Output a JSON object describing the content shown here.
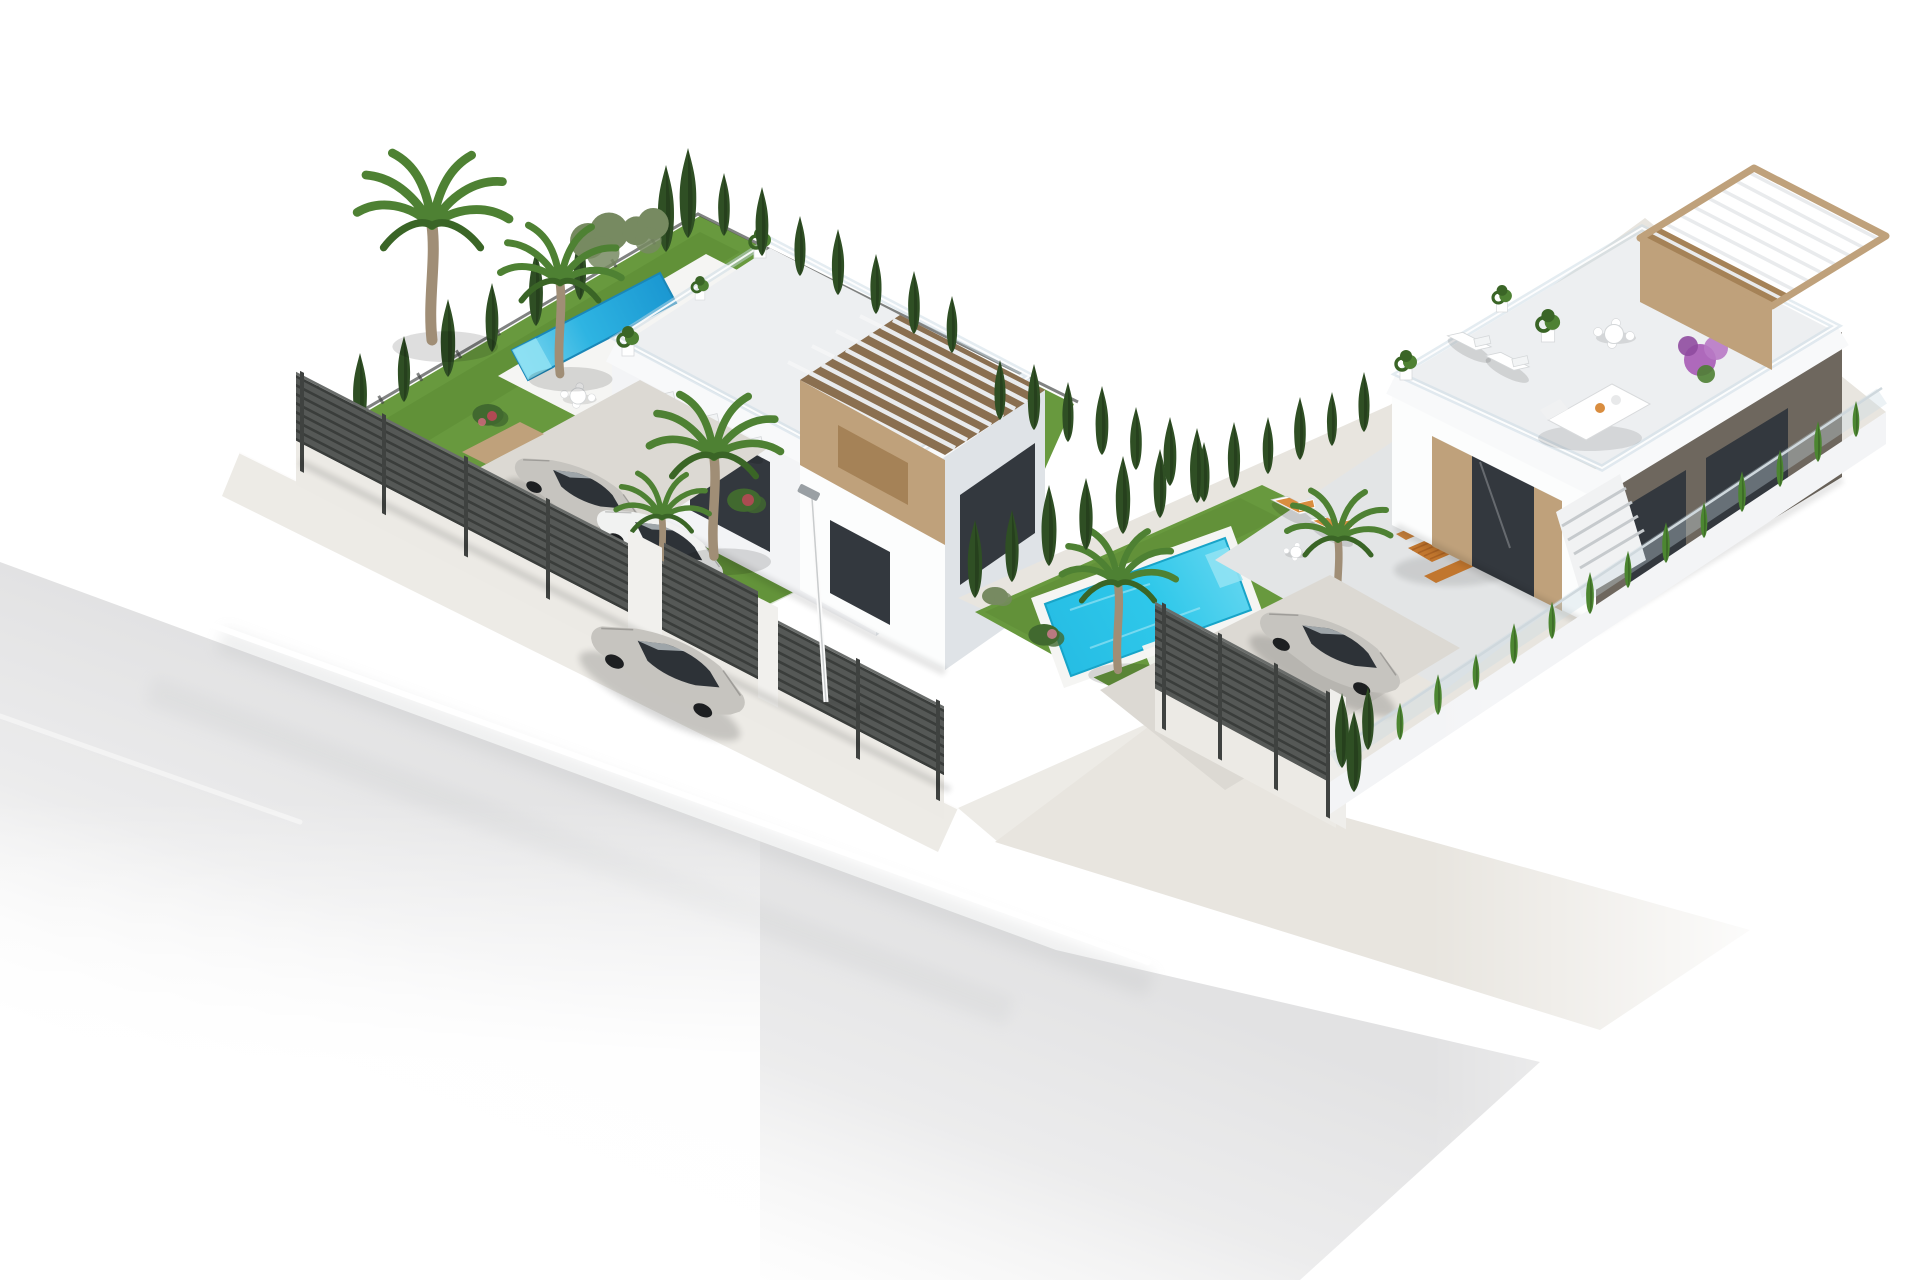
{
  "meta": {
    "canvas_width": 1920,
    "canvas_height": 1280,
    "type": "3d-architectural-render",
    "description": "Aerial isometric 3D visualization on a white background: two modern flat-roof villas on landscaped corner plots with private pools, gardens, cypress hedges, slatted fences, parked cars, a street lamp and a silver sedan driving on the street."
  },
  "colors": {
    "background": "#ffffff",
    "road": "#e3e3e4",
    "road_line": "#ffffff",
    "sidewalk": "#edebe6",
    "paver": "#e8e5df",
    "driveway": "#dcd9d3",
    "lawn": "#68993e",
    "lawn_dark": "#4f7d2c",
    "cypress": "#2f4f24",
    "cypress_light": "#41692f",
    "hedge_bright": "#4c8631",
    "palm": "#4e8133",
    "palm_dark": "#3a6526",
    "trunk": "#a08e76",
    "olive": "#778a61",
    "pool": "#2cc3e6",
    "pool_deep": "#129fd0",
    "pool_light": "#90e2f3",
    "coping": "#f5f5f3",
    "wall_white": "#fcfdfd",
    "wall_light": "#f3f4f6",
    "wall_shade": "#dfe3e7",
    "wall_dark": "#cdd2d8",
    "dark_face": "#6e675e",
    "fascia": "#f8f9fa",
    "glass": "#33383e",
    "rail": "#c9dae3",
    "tan": "#bfa17b",
    "tan_dark": "#a58257",
    "wood_slat_bg": "#8a6f50",
    "slat_light": "#e9ebed",
    "fence": "#555856",
    "fence_dark": "#3a3d3b",
    "fence_base": "#eceae5",
    "floor_roof": "#edeff1",
    "floor_terrace": "#e3e5e6",
    "car_silver": "#c6c4bf",
    "car_white": "#f1f2f1",
    "car_glass": "#2d3237",
    "wood": "#c1762e",
    "cushion": "#d98d3f"
  },
  "scene": {
    "plots": [
      {
        "name": "left-villa-plot",
        "features": [
          "lap-pool",
          "white-roof-terrace",
          "tan-pergola",
          "lawn-garden",
          "palm-trees",
          "cypress-boundary-trees",
          "parking-court",
          "horizontal-slat-fence",
          "two-parked-cars",
          "sun-loungers",
          "garden-table"
        ]
      },
      {
        "name": "right-villa-plot",
        "features": [
          "turquoise-pool",
          "lawn",
          "paved-terrace",
          "roof-terrace",
          "wood-pergola",
          "outdoor-dining-set",
          "orange-sun-loungers",
          "round-table-set",
          "lounge-sofa",
          "driveway",
          "two-parked-cars",
          "glass-and-hedge-fence",
          "slat-gate-fence",
          "external-stairs",
          "bougainvillea"
        ]
      }
    ],
    "street": {
      "elements": [
        "asphalt-road",
        "white-lane-marking",
        "sidewalk",
        "street-lamp",
        "silver-sedan-driving"
      ]
    },
    "counts": {
      "villas": 2,
      "pools": 2,
      "cars": 5,
      "street_lamps": 1
    }
  }
}
